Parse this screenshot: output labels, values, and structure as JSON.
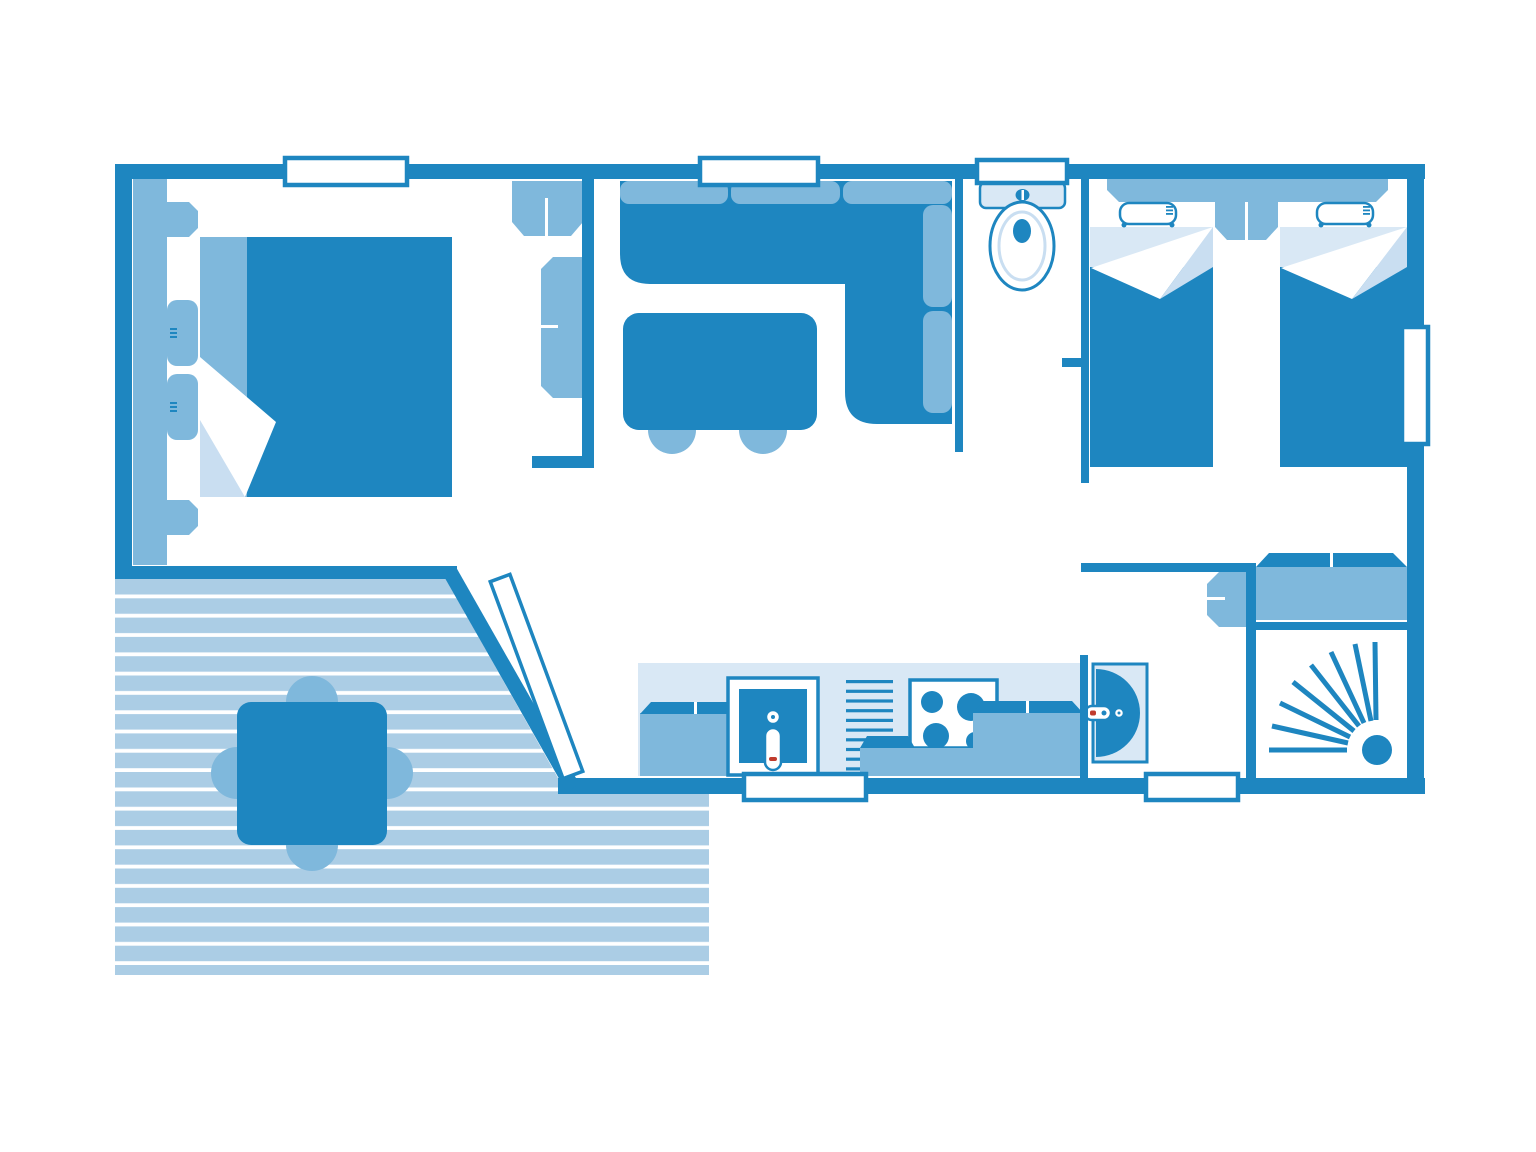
{
  "diagram": {
    "type": "floor-plan",
    "subject": "mobile-home-top-view",
    "palette": {
      "wall": "#1e86c0",
      "furn": "#7fb8dc",
      "pale": "#d9e8f5",
      "shadow": "#c9def1",
      "plank": "#abcde5",
      "red": "#c03b2d",
      "background": "#ffffff"
    },
    "rooms": [
      {
        "name": "master-bedroom",
        "furniture": [
          "double-bed",
          "pillows",
          "nightstand",
          "nightstand",
          "wall-shelf",
          "wardrobe",
          "side-cabinet"
        ]
      },
      {
        "name": "living-room",
        "furniture": [
          "corner-sofa",
          "dining-table",
          "stool",
          "stool"
        ]
      },
      {
        "name": "wc",
        "furniture": [
          "toilet"
        ]
      },
      {
        "name": "twin-bedroom",
        "furniture": [
          "single-bed",
          "single-bed",
          "headboard-shelf",
          "nightstand"
        ]
      },
      {
        "name": "shower-room",
        "furniture": [
          "washbasin",
          "shower",
          "wardrobe",
          "cabinet"
        ]
      },
      {
        "name": "kitchen",
        "furniture": [
          "cabinet",
          "sink",
          "faucet",
          "drainer",
          "hob",
          "counter"
        ]
      },
      {
        "name": "deck",
        "furniture": [
          "outdoor-table",
          "chair",
          "chair",
          "chair",
          "chair"
        ]
      }
    ],
    "openings": {
      "windows": 6,
      "entrance": "sliding-door-angled"
    }
  }
}
